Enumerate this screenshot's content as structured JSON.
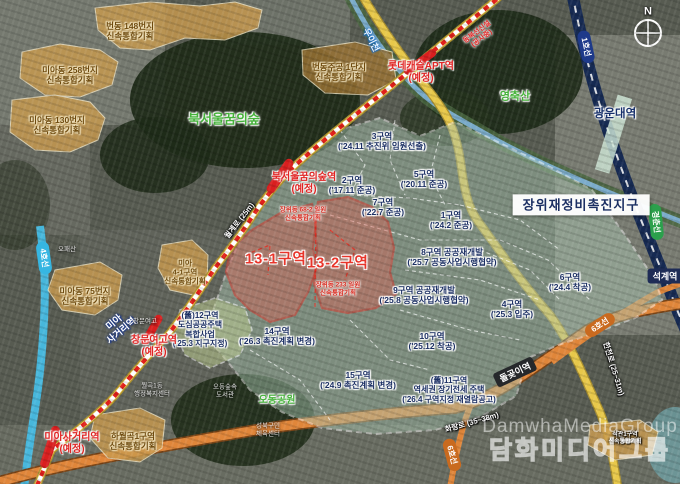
{
  "compass": "N",
  "title": "장위재정비촉진지구",
  "watermark": {
    "en": "DamwhaMediaGroup",
    "ko": "담화미디어그룹"
  },
  "parks": [
    {
      "name": "북서울꿈의숲"
    },
    {
      "name": "영축산"
    },
    {
      "name": "오동공원"
    }
  ],
  "fast_zones": [
    {
      "name": "번동 148번지\n신속통합기획"
    },
    {
      "name": "미아동 258번지\n신속통합기획"
    },
    {
      "name": "미아동 130번지\n신속통합기획"
    },
    {
      "name": "번동주공 1단지\n신속통합기획"
    },
    {
      "name": "미아동 75번지\n신속통합기획"
    },
    {
      "name": "미아\n4-1구역\n신속통합기획"
    },
    {
      "name": "하월곡1구역\n신속통합기획"
    },
    {
      "name": "석관1구역\n신속통합기획"
    }
  ],
  "districts": [
    {
      "label": "3구역\n('24.11 추진위 임원선출)"
    },
    {
      "label": "2구역\n('17.11 준공)"
    },
    {
      "label": "5구역\n('20.11 준공)"
    },
    {
      "label": "7구역\n('22.7 준공)"
    },
    {
      "label": "1구역\n('24.2 준공)"
    },
    {
      "label": "8구역 공공재개발\n('25.7 공동사업시행협약)"
    },
    {
      "label": "9구역 공공재개발\n('25.8 공동사업시행협약)"
    },
    {
      "label": "6구역\n('24.4 착공)"
    },
    {
      "label": "4구역\n('25.3 입주)"
    },
    {
      "label": "10구역\n('25.12 착공)"
    },
    {
      "label": "14구역\n('26.3 촉진계획 변경)"
    },
    {
      "label": "15구역\n('24.9 촉진계획 변경)"
    },
    {
      "label": "(舊)11구역\n역세권 장기전세 주택\n('26.4 구역지정 재열람공고)"
    },
    {
      "label": "(舊)12구역\n도심공공주택\n복합사업\n('25.3 지구지정)"
    }
  ],
  "red_zones": [
    {
      "name": "13-1구역"
    },
    {
      "name": "13-2구역"
    }
  ],
  "red_notes": [
    {
      "text": "장위동 68-2 일원\n신속통합기획"
    },
    {
      "text": "장위동 233 일원\n신속통합기획"
    }
  ],
  "planned_stations": [
    {
      "name": "롯데캐슬APT역\n(예정)"
    },
    {
      "name": "북서울꿈의숲역\n(예정)"
    },
    {
      "name": "창문여고역\n(예정)"
    },
    {
      "name": "미아사거리역\n(예정)"
    }
  ],
  "stations": [
    {
      "name": "광운대역"
    },
    {
      "name": "석계역"
    },
    {
      "name": "돌곶이역"
    },
    {
      "name": "미아\n사거리역"
    }
  ],
  "line_badges": [
    {
      "name": "1호선",
      "color": "#1e3a8a"
    },
    {
      "name": "4호선",
      "color": "#36b6e2"
    },
    {
      "name": "경춘선",
      "color": "#2ba04c"
    },
    {
      "name": "6호선",
      "color": "#c96a1f"
    },
    {
      "name": "6호선",
      "color": "#c96a1f"
    }
  ],
  "rail_note": "동북선신설\n(공사중)",
  "roads": [
    {
      "name": "월계로 (25m)"
    },
    {
      "name": "한천로 (25~31m)"
    },
    {
      "name": "화랑로 (35~38m)"
    }
  ],
  "river": "우이천",
  "poi": [
    {
      "name": "성북구민\n체육센터"
    },
    {
      "name": "오동숲속\n도서관"
    },
    {
      "name": "월곡1동\n행정복지센터"
    },
    {
      "name": "창문여고"
    },
    {
      "name": "오패산"
    }
  ]
}
